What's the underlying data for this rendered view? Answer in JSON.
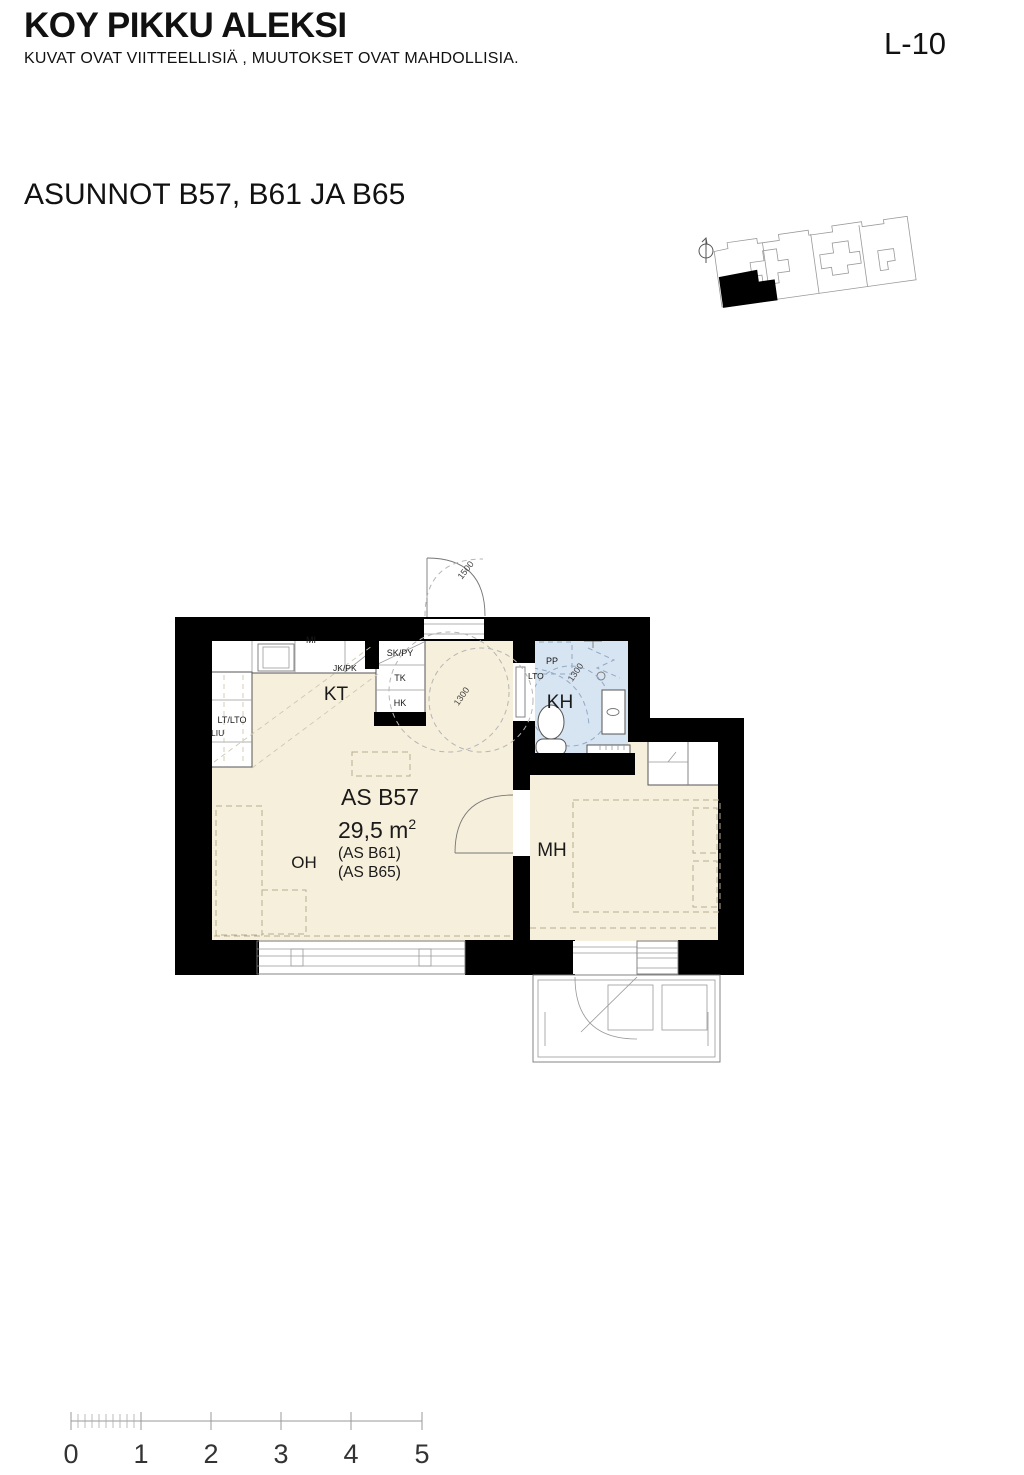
{
  "header": {
    "title": "KOY PIKKU ALEKSI",
    "disclaimer": "KUVAT OVAT VIITTEELLISIÄ , MUUTOKSET OVAT MAHDOLLISIA.",
    "sheet_number": "L-10"
  },
  "plan_heading": "ASUNNOT B57, B61 JA B65",
  "apartment": {
    "id": "AS B57",
    "area": "29,5 m",
    "area_exponent": "2",
    "variant_1": "(AS B61)",
    "variant_2": "(AS B65)"
  },
  "rooms": {
    "kitchen": "KT",
    "living_room": "OH",
    "bedroom": "MH",
    "bathroom": "KH"
  },
  "fixtures": {
    "microwave": "MI",
    "fridge_freezer": "JK/PK",
    "cleaning_cabinet": "SK/PY",
    "tk": "TK",
    "hk": "HK",
    "lt_lto": "LT/LTO",
    "liu": "LIU",
    "washer_place": "PP",
    "lto": "LTO"
  },
  "dimensions": {
    "entrance_clearance": "1500",
    "hall_circle": "1300",
    "bathroom_circle": "1300"
  },
  "scale_bar": {
    "labels": [
      "0",
      "1",
      "2",
      "3",
      "4",
      "5"
    ]
  },
  "colors": {
    "floor_beige": "#f6efdb",
    "bathroom_blue": "#d7e4f2",
    "wall_black": "#000000"
  }
}
